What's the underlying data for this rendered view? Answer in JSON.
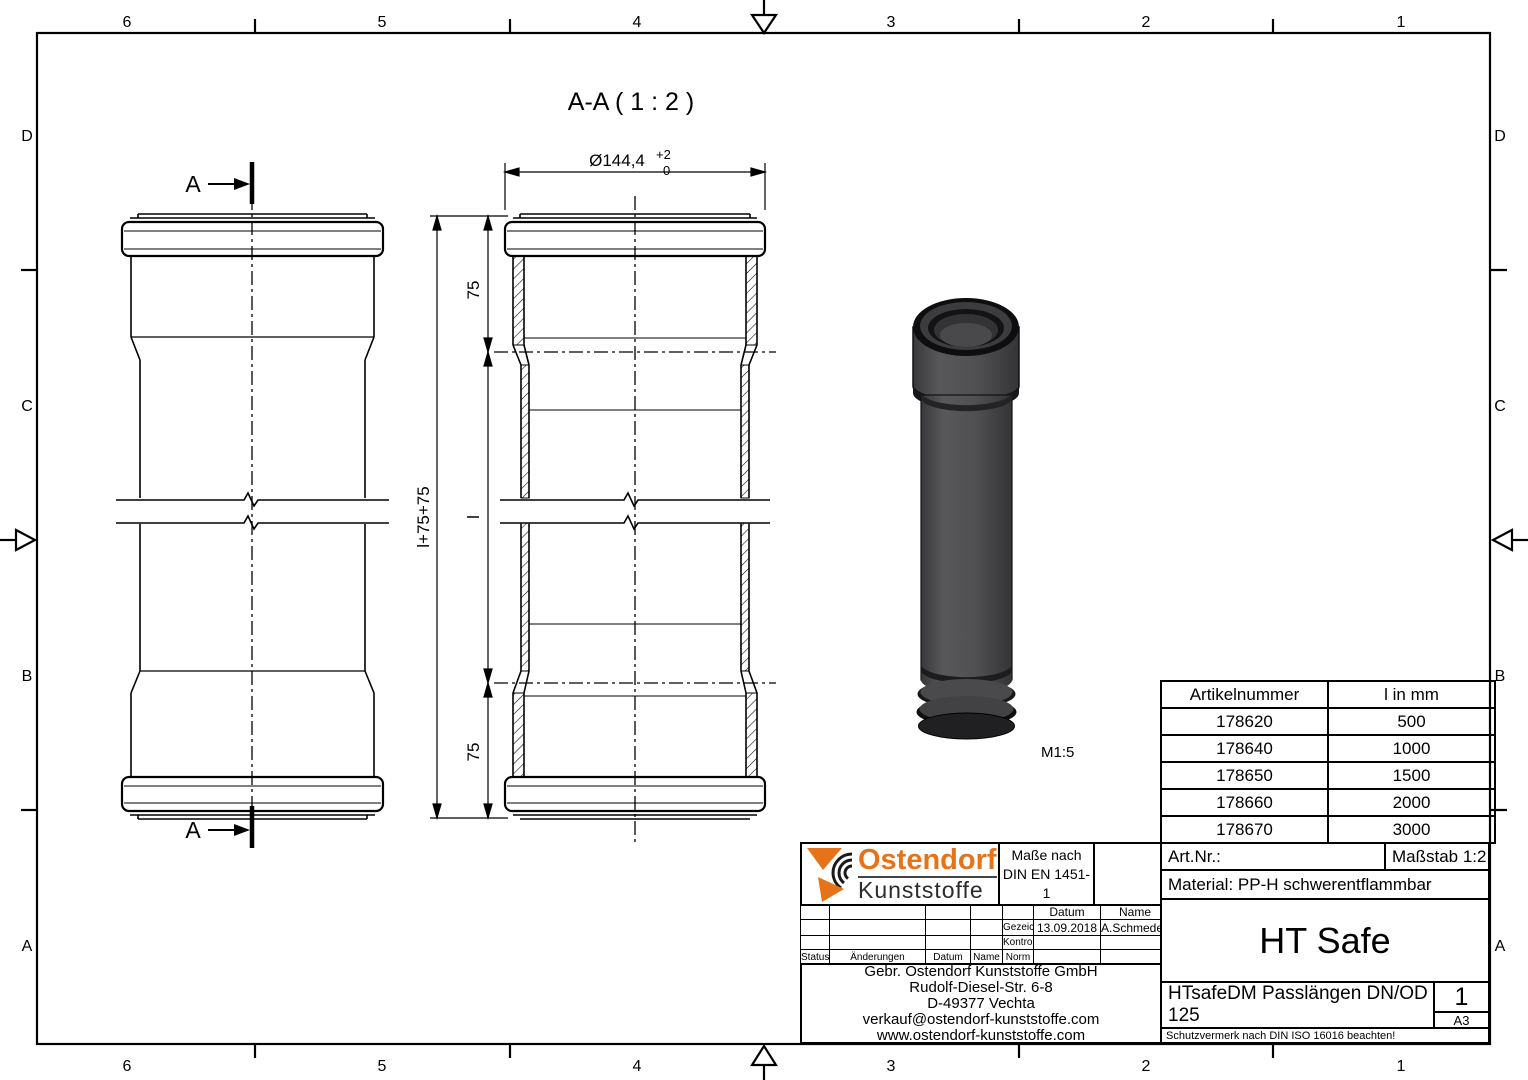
{
  "frame": {
    "zone_numbers": [
      "6",
      "5",
      "4",
      "3",
      "2",
      "1"
    ],
    "zone_letters": [
      "D",
      "C",
      "B",
      "A"
    ]
  },
  "drawing": {
    "section_title": "A-A ( 1 : 2 )",
    "section_label": "A",
    "dim_diameter": "Ø144,4",
    "dim_tol_upper": "+2",
    "dim_tol_lower": "0",
    "dim_total": "l+75+75",
    "dim_top": "75",
    "dim_mid": "l",
    "dim_bottom": "75",
    "render_scale": "M1:5"
  },
  "article_table": {
    "headers": [
      "Artikelnummer",
      "l in mm"
    ],
    "rows": [
      [
        "178620",
        "500"
      ],
      [
        "178640",
        "1000"
      ],
      [
        "178650",
        "1500"
      ],
      [
        "178660",
        "2000"
      ],
      [
        "178670",
        "3000"
      ]
    ]
  },
  "title_block": {
    "logo_line1": "Ostendorf",
    "logo_line2": "Kunststoffe",
    "masse_line1": "Maße nach",
    "masse_line2": "DIN EN 1451-1",
    "col_datum": "Datum",
    "col_name": "Name",
    "row_gezeichn": "Gezeichn.",
    "row_kontroll": "Kontroll.",
    "row_norm": "Norm",
    "gezeichn_datum": "13.09.2018",
    "gezeichn_name": "A.Schmedes",
    "status": "Status",
    "aenderungen": "Änderungen",
    "datum": "Datum",
    "name": "Name",
    "address": [
      "Gebr. Ostendorf Kunststoffe GmbH",
      "Rudolf-Diesel-Str. 6-8",
      "D-49377 Vechta",
      "verkauf@ostendorf-kunststoffe.com",
      "www.ostendorf-kunststoffe.com"
    ],
    "art_nr": "Art.Nr.:",
    "massstab": "Maßstab 1:2",
    "material": "Material: PP-H schwerentflammbar",
    "product": "HT Safe",
    "description": "HTsafeDM Passlängen DN/OD 125",
    "sheet": "1",
    "format": "A3",
    "note": "Schutzvermerk nach DIN ISO 16016 beachten!"
  },
  "colors": {
    "accent_orange": "#e5731a",
    "line": "#000000",
    "pipe_gray": "#4e4e50"
  }
}
